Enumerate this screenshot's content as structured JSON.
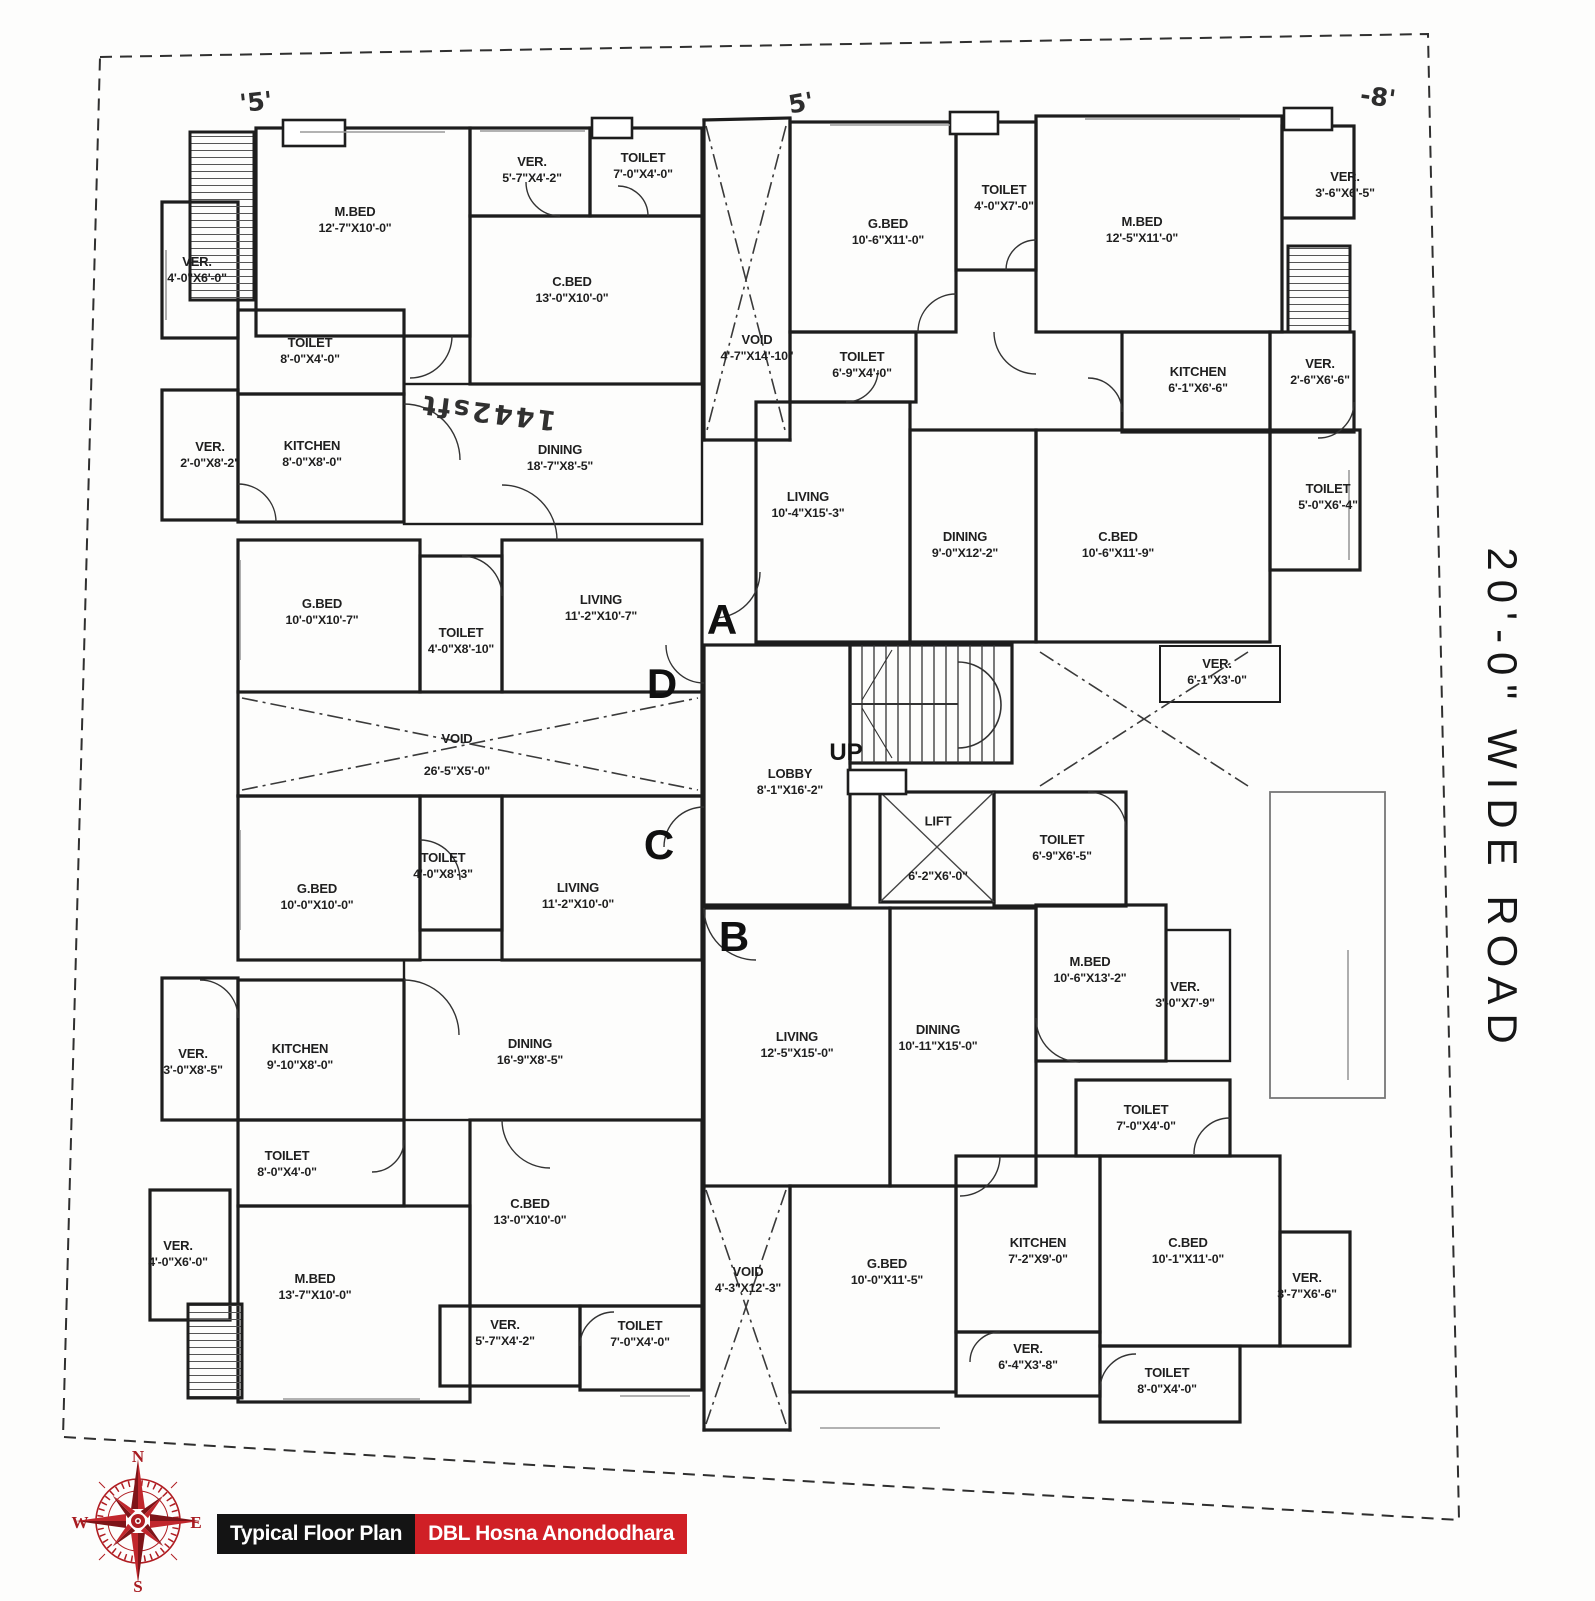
{
  "footer": {
    "label_left": "Typical Floor Plan",
    "label_right": "DBL Hosna Anondodhara",
    "left_bg": "#141414",
    "right_bg": "#d02026"
  },
  "road_label": "20'-0\" WIDE ROAD",
  "stairs": {
    "up_label": "UP"
  },
  "unit_letters": {
    "a": "A",
    "b": "B",
    "c": "C",
    "d": "D"
  },
  "compass": {
    "n": "N",
    "e": "E",
    "s": "S",
    "w": "W",
    "color": "#b01d22"
  },
  "annotations": {
    "top_left": "'5'",
    "top_mid": "5'",
    "top_right": "-8'",
    "area_note": "1442sft"
  },
  "rooms": [
    {
      "name": "M.BED",
      "dim": "12'-7\"X10'-0\""
    },
    {
      "name": "VER.",
      "dim": "5'-7\"X4'-2\""
    },
    {
      "name": "TOILET",
      "dim": "7'-0\"X4'-0\""
    },
    {
      "name": "VER.",
      "dim": "4'-0\"X6'-0\""
    },
    {
      "name": "C.BED",
      "dim": "13'-0\"X10'-0\""
    },
    {
      "name": "TOILET",
      "dim": "8'-0\"X4'-0\""
    },
    {
      "name": "VER.",
      "dim": "2'-0\"X8'-2\""
    },
    {
      "name": "KITCHEN",
      "dim": "8'-0\"X8'-0\""
    },
    {
      "name": "DINING",
      "dim": "18'-7\"X8'-5\""
    },
    {
      "name": "G.BED",
      "dim": "10'-0\"X10'-7\""
    },
    {
      "name": "TOILET",
      "dim": "4'-0\"X8'-10\""
    },
    {
      "name": "LIVING",
      "dim": "11'-2\"X10'-7\""
    },
    {
      "name": "VOID",
      "dim": "26'-5\"X5'-0\""
    },
    {
      "name": "G.BED",
      "dim": "10'-6\"X11'-0\""
    },
    {
      "name": "TOILET",
      "dim": "4'-0\"X7'-0\""
    },
    {
      "name": "M.BED",
      "dim": "12'-5\"X11'-0\""
    },
    {
      "name": "VER.",
      "dim": "3'-6\"X6'-5\""
    },
    {
      "name": "VOID",
      "dim": "4'-7\"X14'-10\""
    },
    {
      "name": "TOILET",
      "dim": "6'-9\"X4'-0\""
    },
    {
      "name": "KITCHEN",
      "dim": "6'-1\"X6'-6\""
    },
    {
      "name": "VER.",
      "dim": "2'-6\"X6'-6\""
    },
    {
      "name": "LIVING",
      "dim": "10'-4\"X15'-3\""
    },
    {
      "name": "DINING",
      "dim": "9'-0\"X12'-2\""
    },
    {
      "name": "C.BED",
      "dim": "10'-6\"X11'-9\""
    },
    {
      "name": "TOILET",
      "dim": "5'-0\"X6'-4\""
    },
    {
      "name": "VER.",
      "dim": "6'-1\"X3'-0\""
    },
    {
      "name": "LOBBY",
      "dim": "8'-1\"X16'-2\""
    },
    {
      "name": "LIFT",
      "dim": "6'-2\"X6'-0\""
    },
    {
      "name": "TOILET",
      "dim": "6'-9\"X6'-5\""
    },
    {
      "name": "G.BED",
      "dim": "10'-0\"X10'-0\""
    },
    {
      "name": "TOILET",
      "dim": "4'-0\"X8'-3\""
    },
    {
      "name": "LIVING",
      "dim": "11'-2\"X10'-0\""
    },
    {
      "name": "VER.",
      "dim": "3'-0\"X8'-5\""
    },
    {
      "name": "KITCHEN",
      "dim": "9'-10\"X8'-0\""
    },
    {
      "name": "DINING",
      "dim": "16'-9\"X8'-5\""
    },
    {
      "name": "TOILET",
      "dim": "8'-0\"X4'-0\""
    },
    {
      "name": "VER.",
      "dim": "4'-0\"X6'-0\""
    },
    {
      "name": "M.BED",
      "dim": "13'-7\"X10'-0\""
    },
    {
      "name": "C.BED",
      "dim": "13'-0\"X10'-0\""
    },
    {
      "name": "VER.",
      "dim": "5'-7\"X4'-2\""
    },
    {
      "name": "TOILET",
      "dim": "7'-0\"X4'-0\""
    },
    {
      "name": "LIVING",
      "dim": "12'-5\"X15'-0\""
    },
    {
      "name": "DINING",
      "dim": "10'-11\"X15'-0\""
    },
    {
      "name": "M.BED",
      "dim": "10'-6\"X13'-2\""
    },
    {
      "name": "VER.",
      "dim": "3'-0\"X7'-9\""
    },
    {
      "name": "TOILET",
      "dim": "7'-0\"X4'-0\""
    },
    {
      "name": "VOID",
      "dim": "4'-3\"X12'-3\""
    },
    {
      "name": "G.BED",
      "dim": "10'-0\"X11'-5\""
    },
    {
      "name": "KITCHEN",
      "dim": "7'-2\"X9'-0\""
    },
    {
      "name": "C.BED",
      "dim": "10'-1\"X11'-0\""
    },
    {
      "name": "VER.",
      "dim": "3'-7\"X6'-6\""
    },
    {
      "name": "VER.",
      "dim": "6'-4\"X3'-8\""
    },
    {
      "name": "TOILET",
      "dim": "8'-0\"X4'-0\""
    }
  ]
}
